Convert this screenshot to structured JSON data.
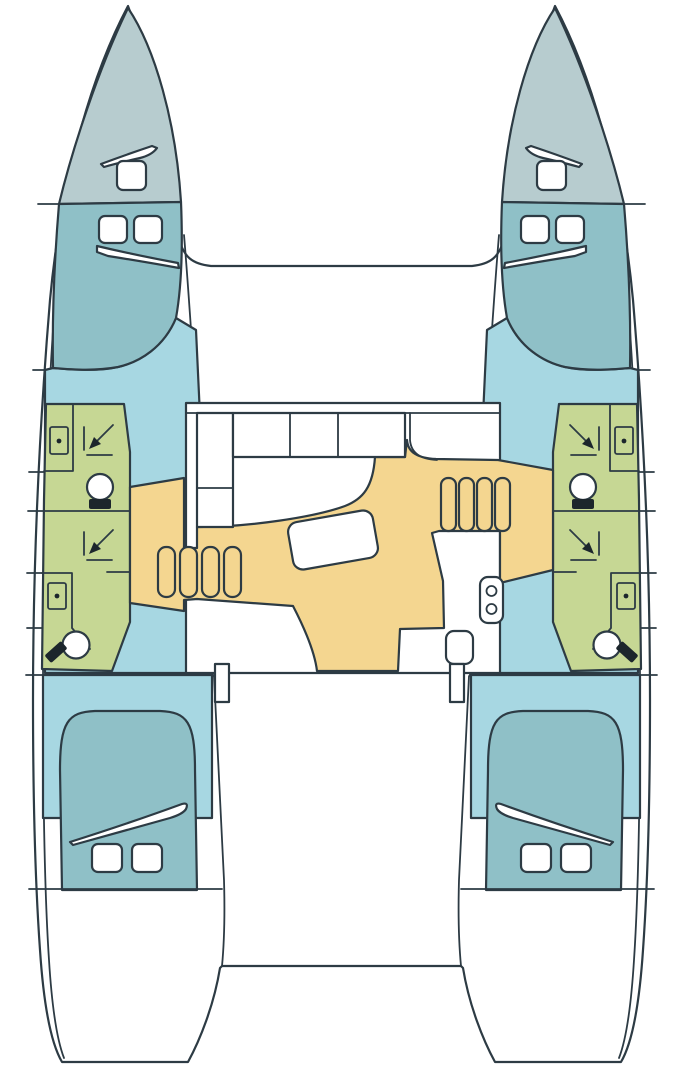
{
  "meta": {
    "description": "Top-down interior floor plan of a sailing catamaran (two hulls joined by a central saloon)",
    "view": "deck layout plan, bows at top, sterns at bottom",
    "text_on_image": ""
  },
  "colors": {
    "background": "#ffffff",
    "outline": "#2d3b44",
    "bow": "#b7cccf",
    "bed": "#8fc0c7",
    "floor": "#a7d7e2",
    "bath": "#c6d794",
    "orange": "#f4d690",
    "white": "#ffffff",
    "dark": "#1c262c"
  },
  "layout": {
    "hulls": 2,
    "cabins": 4,
    "bathrooms": 4,
    "saloon": 1,
    "stair_flights": 2,
    "stair_treads_per_flight": 4
  },
  "rooms": {
    "port_hull": [
      "bow locker deck",
      "forward double cabin",
      "forward bathroom with shower, sink, toilet",
      "aft bathroom with shower, sink, toilet",
      "aft double cabin"
    ],
    "starboard_hull": [
      "bow locker deck",
      "forward double cabin",
      "forward bathroom with shower, sink, toilet",
      "aft bathroom with shower, sink, toilet",
      "aft double cabin"
    ],
    "bridge_deck": [
      "saloon with U-settee and table",
      "navigation seat",
      "L-shaped galley with two-burner stove and sink",
      "cockpit aft"
    ]
  },
  "icons": {
    "toilet": "circle with dark cistern block",
    "sink": "small rectangle with center dot",
    "shower": "corner lines with diagonal arrow",
    "stairs": "row of rounded treads",
    "stove": "rounded rectangle with two burner circles",
    "table": "rotated rounded rectangle",
    "hatch": "rounded square",
    "window_vent": "thin curved sliver"
  }
}
